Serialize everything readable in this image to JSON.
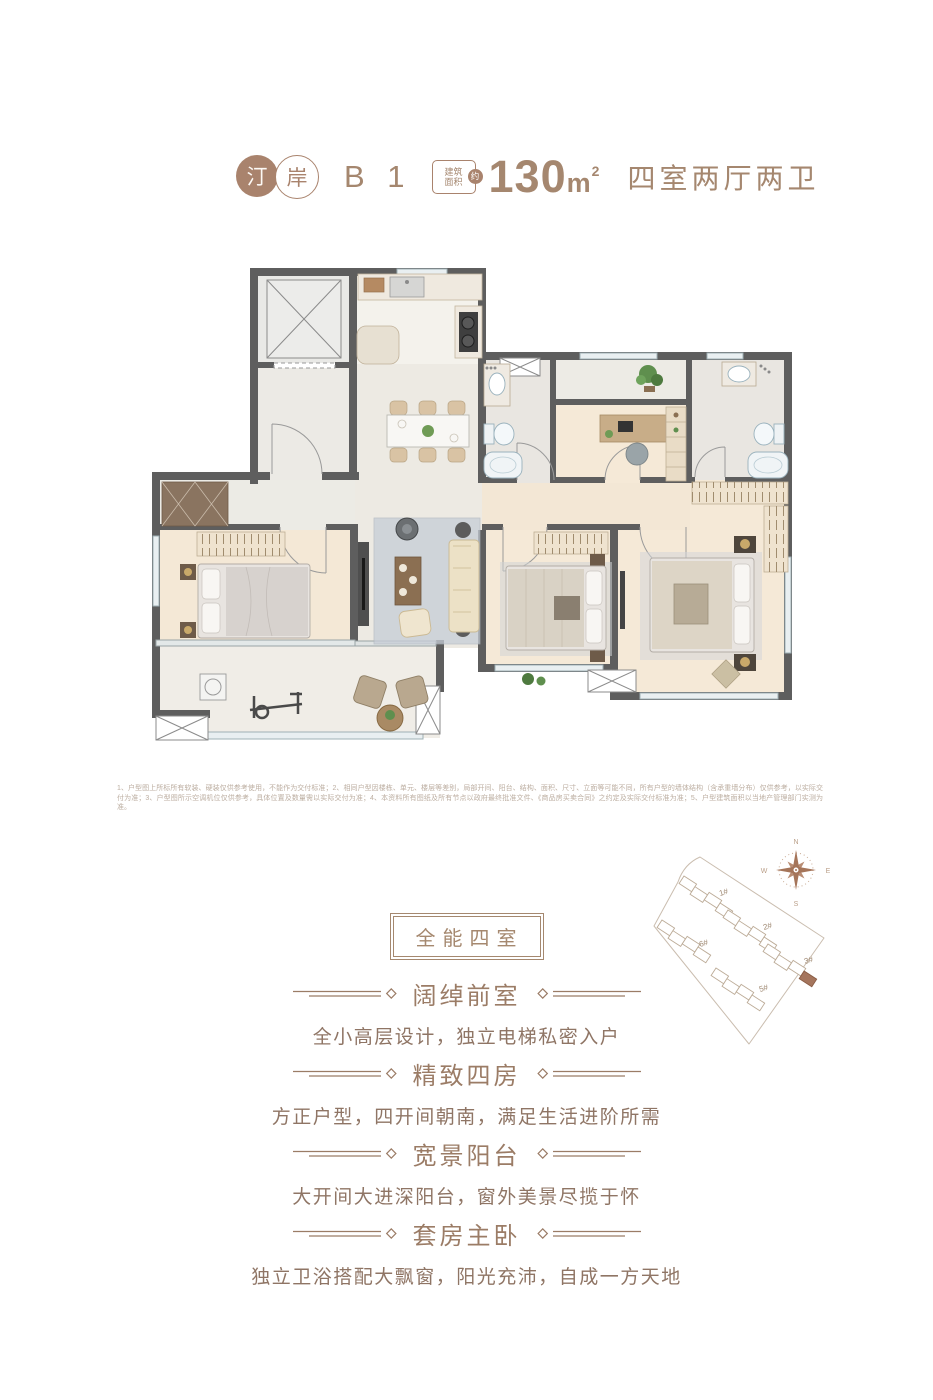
{
  "header": {
    "logo_char_1": "汀",
    "logo_char_2": "岸",
    "unit": "B 1",
    "area_badge_line1": "建筑",
    "area_badge_line2": "面积",
    "area_badge_circle": "约",
    "area_value": "130",
    "area_unit": "m",
    "area_sup": "2",
    "layout": "四室两厅两卫"
  },
  "disclaimer": "1、户型图上所标所有软装、硬装仅供参考使用，不能作为交付标准；2、相同户型因楼栋、单元、楼层等差别，局部开间、阳台、结构、面积、尺寸、立面等可能不同，所有户型的墙体结构（含承重墙分布）仅供参考，以实际交付为准；3、户型图所示空调机位仅供参考，具体位置及数量需以实际交付为准；4、本资料所有图纸及所有节点以政府最终批准文件、《商品房买卖合同》之约定及实际交付标准为准；5、户型建筑面积以当地产管理部门实测为准。",
  "sections": {
    "badge": "全能四室",
    "features": [
      {
        "title": "阔绰前室",
        "desc": "全小高层设计，独立电梯私密入户"
      },
      {
        "title": "精致四房",
        "desc": "方正户型，四开间朝南，满足生活进阶所需"
      },
      {
        "title": "宽景阳台",
        "desc": "大开间大进深阳台，窗外美景尽揽于怀"
      },
      {
        "title": "套房主卧",
        "desc": "独立卫浴搭配大飘窗，阳光充沛，自成一方天地"
      }
    ]
  },
  "site_plan": {
    "buildings": {
      "b1": "1#",
      "b2": "2#",
      "b3": "3#",
      "b5": "5#",
      "b6": "6#"
    },
    "compass": {
      "n": "N",
      "e": "E",
      "s": "S",
      "w": "W"
    }
  },
  "colors": {
    "accent": "#a5886f",
    "wall": "#5e5e5e",
    "text_body": "#8f7565",
    "disclaimer": "#bcaea1"
  }
}
